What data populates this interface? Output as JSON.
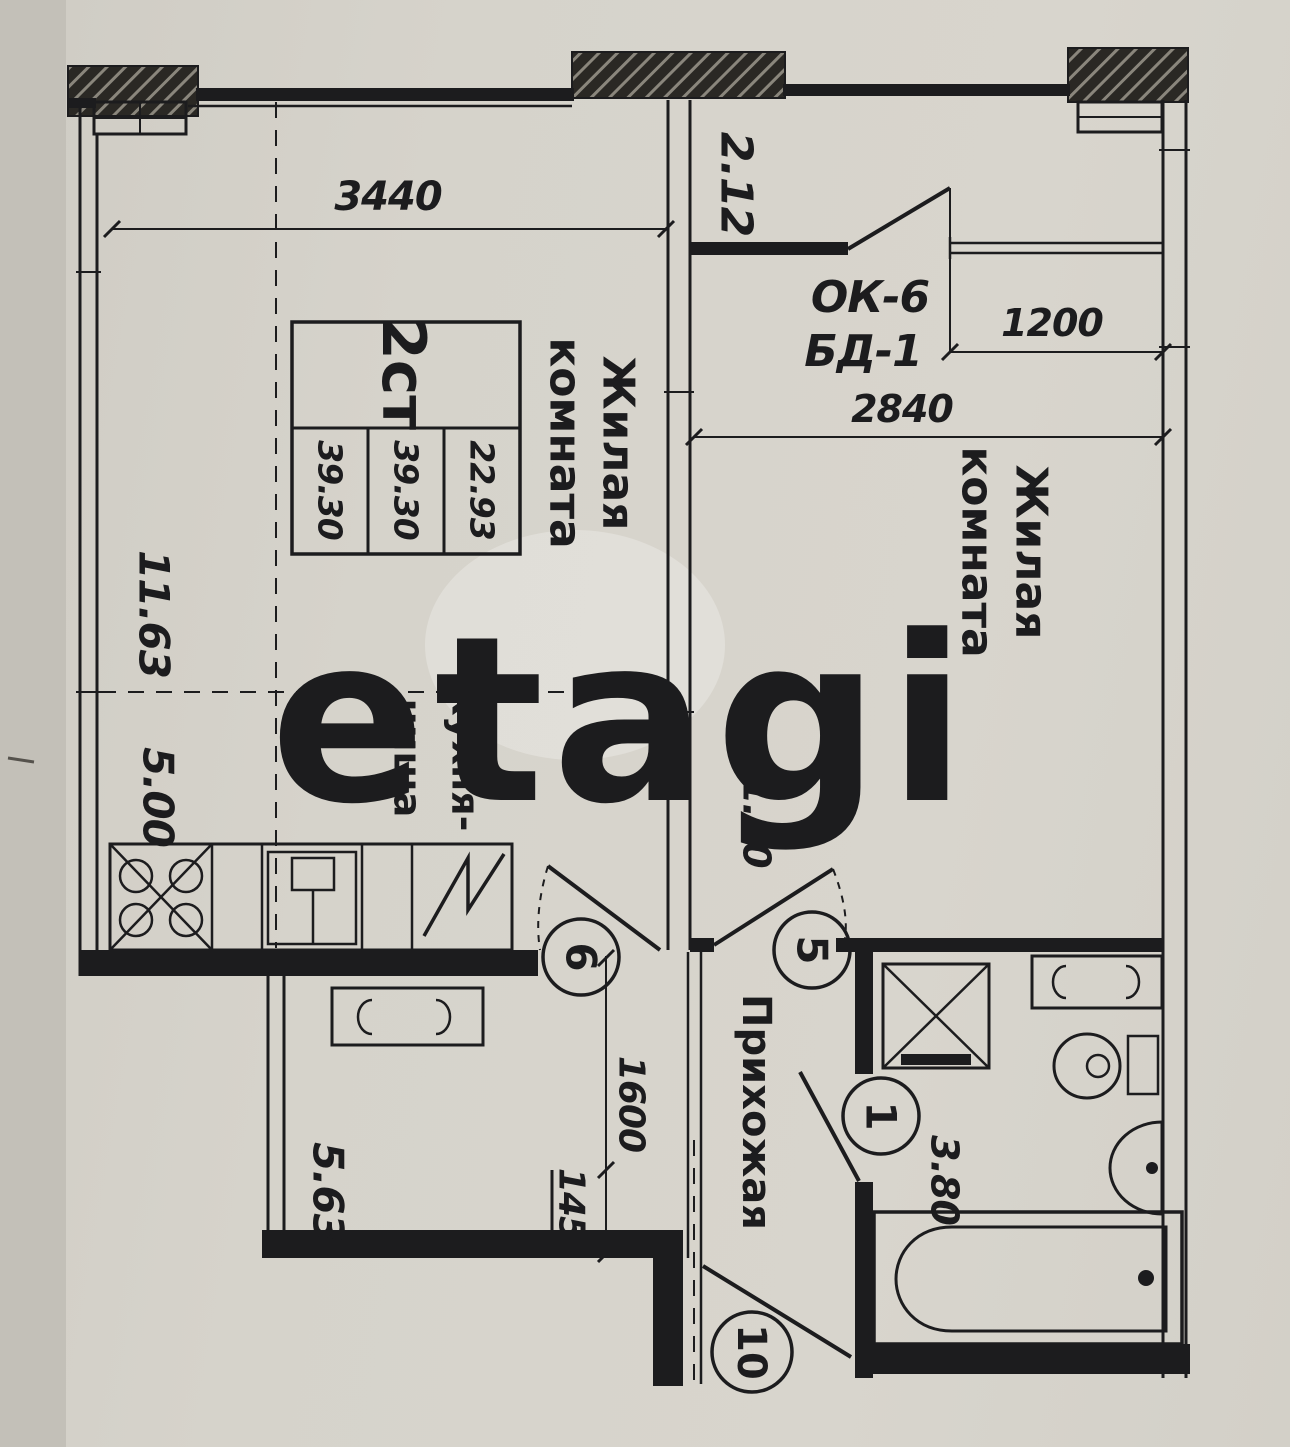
{
  "stamp": {
    "type": "2ст",
    "living_area": "22.93",
    "total_area": "39.30",
    "total_area_alt": "39.30"
  },
  "rooms": {
    "living1": {
      "line1": "Жилая",
      "line2": "комната",
      "area": "11.63"
    },
    "living2": {
      "line1": "Жилая",
      "line2": "комната",
      "area": "11.30"
    },
    "kitchen": {
      "line1": "Кухня-",
      "line2": "ниша",
      "area": "5.00"
    },
    "hallway": {
      "name": "Прихожая",
      "area": "5.63"
    },
    "bathroom": {
      "area": "3.80"
    },
    "balcony": {
      "area": "2.12"
    }
  },
  "dimensions": {
    "top_width": "3440",
    "window_width": "1200",
    "room_width": "2840",
    "hall_length": "1600",
    "hall_width": "145"
  },
  "openings": {
    "window_code": "ОК-6",
    "balcony_door_code": "БД-1"
  },
  "doors": {
    "kitchen": "6",
    "room": "5",
    "bathroom": "1",
    "entrance": "10"
  },
  "watermark": "etagi",
  "colors": {
    "paper": "#d4d1c9",
    "ink": "#1c1c1e",
    "watermark_rgba": "rgba(255,255,255,0.5)"
  }
}
